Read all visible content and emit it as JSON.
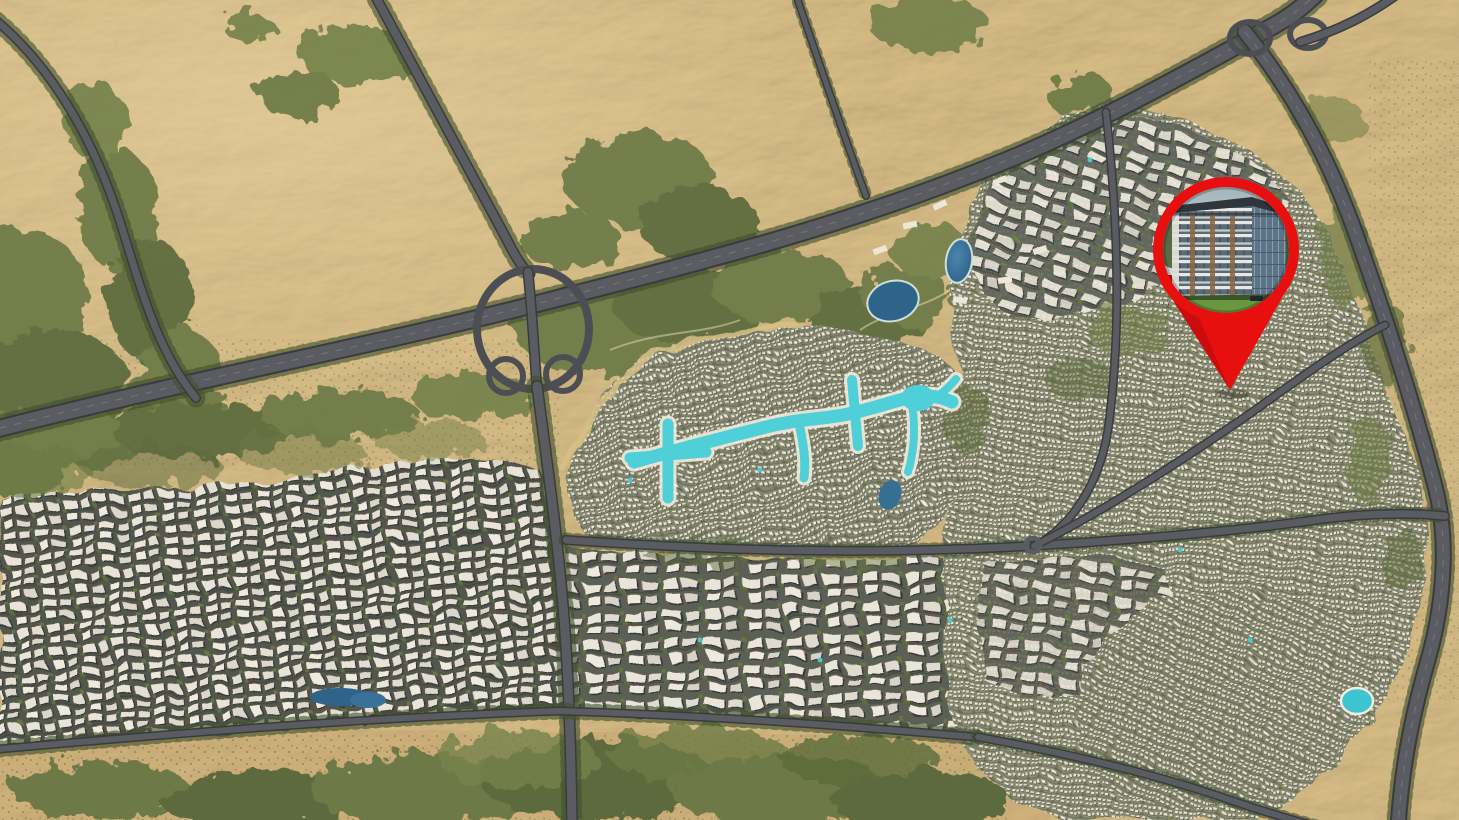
{
  "page": {
    "title": "Compound masterplan aerial map"
  },
  "map": {
    "type": "aerial-masterplan",
    "description": "Photorealistic top-down aerial rendering of a desert-city masterplan: sand dunes on the upper-left and right, a main tree-lined highway with a cloverleaf interchange, dense residential districts, a winding turquoise crystal lagoon, two dark blue lakes, and a red location pin with a photo of the featured residential building in the upper right.",
    "colors": {
      "sand": "#d8bd86",
      "sand_dark": "#b9905a",
      "scrub_green": "#6d7a46",
      "scrub_green_dark": "#5b6a3c",
      "road": "#5a5c61",
      "road_edge": "#393b3f",
      "city_roof": "#eae5d8",
      "city_ground": "#565949",
      "lagoon": "#4fd0d8",
      "lagoon_shore": "#f2eddc",
      "lake": "#2e6489",
      "pool": "#3cc4d0",
      "pin_red": "#e80f0f",
      "pin_red_shade": "#b50b0b",
      "photo_sky": "#b3c2c6",
      "photo_roof": "#2f353a",
      "photo_wood": "#8a6743",
      "photo_glass": "#5d7486",
      "photo_lawn": "#69973f",
      "photo_hedge": "#3b5429"
    },
    "features": [
      {
        "id": "desert",
        "label": "Desert terrain"
      },
      {
        "id": "highway-main",
        "label": "Main highway"
      },
      {
        "id": "interchange-cloverleaf",
        "label": "Cloverleaf interchange"
      },
      {
        "id": "interchange-northeast",
        "label": "Northeast interchange"
      },
      {
        "id": "district-west-apartments",
        "label": "Western apartment district"
      },
      {
        "id": "district-central-villas",
        "label": "Central villa district"
      },
      {
        "id": "district-south-blocks",
        "label": "Southern residential blocks"
      },
      {
        "id": "district-east",
        "label": "Eastern residential district"
      },
      {
        "id": "crystal-lagoon",
        "label": "Crystal lagoon"
      },
      {
        "id": "lakes",
        "label": "Landscape lakes"
      },
      {
        "id": "location-pin",
        "label": "Highlighted property location"
      }
    ],
    "marker": {
      "name": "property-location-pin",
      "shape": "map pin: red ring with circular building photo and pointer",
      "cx": 1226,
      "cy": 250,
      "radius": 73,
      "tip_x": 1230,
      "tip_y": 390,
      "photo": "low-rise residential building with white balconies, wood accents, glass corner wing and front lawn"
    }
  }
}
